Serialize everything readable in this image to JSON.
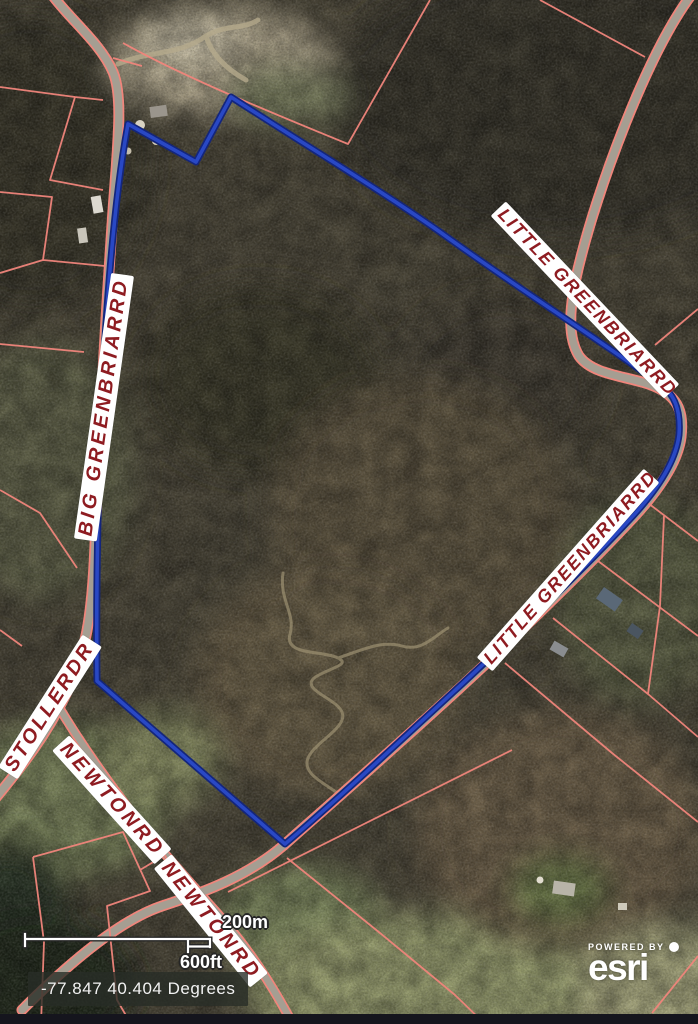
{
  "map": {
    "labels": [
      {
        "id": "big-greenbriar-rd",
        "text": "BIG GREENBRIARRD"
      },
      {
        "id": "little-greenbriar-rd-upper",
        "text": "LITTLE GREENBRIARRD"
      },
      {
        "id": "little-greenbriar-rd-lower",
        "text": "LITTLE GREENBRIARRD"
      },
      {
        "id": "stoller-dr",
        "text": "STOLLERDR"
      },
      {
        "id": "newton-rd-upper",
        "text": "NEWTONRD"
      },
      {
        "id": "newton-rd-lower",
        "text": "NEWTONRD"
      }
    ],
    "scale_bar": {
      "metric": "200m",
      "imperial": "600ft"
    },
    "coordinates": "-77.847 40.404 Degrees",
    "attribution": {
      "powered_by": "POWERED BY",
      "brand": "esri"
    },
    "colors": {
      "parcel_line_red": "#f0857b",
      "selected_parcel_blue_outer": "#14267c",
      "selected_parcel_blue_inner": "#2948c4",
      "road_gray": "#a59e92",
      "label_text_red": "#8e1c21",
      "label_background": "#ffffff",
      "coords_text": "#f2f2f2"
    },
    "paths": {
      "road_big_stoller": "M 50 -8 C 68 18 100 42 113 72 C 124 98 117 150 112 225 C 105 330 98 455 95 545 C 92 618 86 652 66 694 C 46 736 22 766 -6 800",
      "road_newton": "M 57 704 C 76 736 98 768 122 800 C 152 841 186 878 217 913 C 248 948 272 984 296 1030",
      "road_little": "M 692 -6 C 668 26 646 72 626 122 C 606 172 586 232 576 278 C 569 312 568 338 579 356 C 594 377 634 376 658 388 C 678 398 684 412 681 437 C 678 461 660 489 632 519 C 594 560 528 625 463 685 C 398 745 328 806 284 845 C 248 876 205 892 162 906 C 120 920 70 962 22 1010",
      "dirt_spur": "M 118 64 C 150 50 178 56 206 36 C 226 24 242 30 258 20 M 206 36 C 212 56 228 70 246 80",
      "trail": "M 283 573 C 279 600 296 614 290 634 C 284 656 322 650 338 658 C 352 665 328 668 314 678 C 301 690 336 698 342 712 C 348 727 318 740 309 756 C 300 772 322 782 336 792 M 338 658 C 362 650 382 640 402 646 C 422 652 434 636 448 628",
      "selected_parcel": "M 128 124 L 196 162 L 231 97 C 310 148 380 190 440 232 C 520 290 600 340 661 385 C 674 394 681 409 679 435 C 676 460 659 488 631 518 C 593 559 527 624 462 684 C 397 744 330 806 285 844 L 97 681 C 96 600 98 500 101 420 C 104 340 112 210 128 124 Z",
      "parcels_nw": "M 0 87 L 75 97 L 103 100 M 75 97 L 50 180 L 103 190 M 0 192 L 52 197 L 43 260 L 105 266 M 0 273 L 43 260 M 0 344 L 84 352 M 0 490 L 40 513 L 77 568 M 123 43 C 175 72 240 100 348 144 L 430 0 M 540 0 L 645 57 M 113 58 L 142 66",
      "parcels_sw": "M 0 630 L 22 646 M 33 857 L 123 832 L 150 891 L 107 906 L 117 1000 L 131 1024 M 33 857 L 44 942 L 41 1024 M 140 870 L 165 855 L 178 890 M 287 858 L 380 933 L 455 995 L 485 1024 M 228 892 L 512 750",
      "parcels_e": "M 655 345 L 698 309 M 640 497 L 698 541 M 598 561 L 698 636 M 553 618 L 648 694 M 664 516 L 660 606 L 648 694 M 648 694 L 698 737 M 505 663 L 612 753 L 698 822 M 652 1013 L 698 956",
      "scalebar_shape": "M 5 26 L 5 38 M 5 31 L 190 31 M 190 31 L 190 39 M 168 31 L 168 44 M 168 38.5 L 190 38.5"
    }
  }
}
